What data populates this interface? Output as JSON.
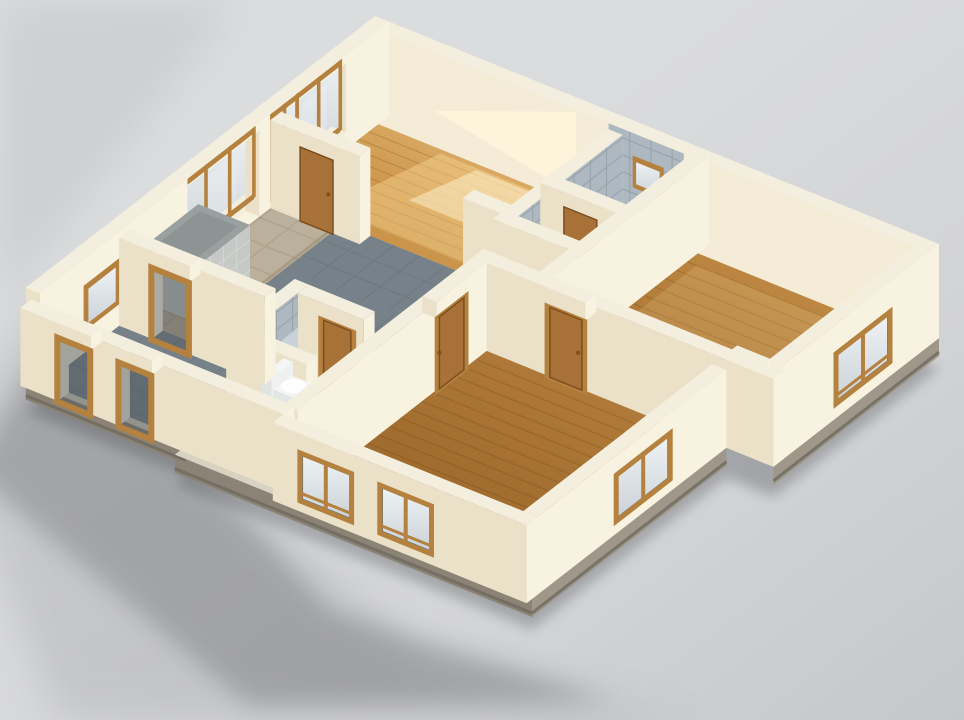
{
  "scene": {
    "description": "Photorealistic 3D isometric cutaway model of an apartment floor plan on a neutral grey studio background: cream plaster walls, oak wood floors and doors, grey tiled hallway and wet rooms, wood-framed glazing along the upper-left facade, soft shadow cast to the lower left",
    "style": "architectural cutaway render",
    "background": "neutral grey studio",
    "camera": "isometric from above"
  },
  "palette": {
    "bg_light": "#dcddde",
    "bg_mid": "#d3d4d6",
    "bg_dark": "#c5c7c9",
    "shadow": "#54575b",
    "wall_top": "#f3eedd",
    "wall_sun": "#f8f3e1",
    "wall_shade": "#eae1c8",
    "wall_inner": "#f4ecd6",
    "slab_side": "#9e978a",
    "slab_dark": "#6f695e",
    "slab_top": "#d8d2c0",
    "wood_light": "#eac183",
    "wood_mid": "#c0893f",
    "wood_dark": "#9a6526",
    "wood_frame": "#b5813f",
    "door_wood": "#a87137",
    "door_dark": "#7c4f1e",
    "tile_hall": "#77818a",
    "tile_bath": "#8b959d",
    "tile_wall": "#adb8c0",
    "tile_line": "#5f6870",
    "pavement": "#b2a58f",
    "pavement_line": "#97896f",
    "concrete": "#b7bab6",
    "concrete_light": "#c6c9c5",
    "concrete_dark": "#9aa0a0",
    "glass_light": "#eef2f4",
    "glass_dark": "#ccd3d8",
    "reveal": "#6b7379",
    "opening_dark": "#4d5459",
    "fixture_white": "#f4f6f5",
    "sun_warm": "#ffdf9e",
    "sun_hot": "#fff3d2"
  },
  "rooms": [
    {
      "id": "living-room",
      "material": "wood-sunlit",
      "features": [
        "sunlight patch",
        "balcony glazed door"
      ]
    },
    {
      "id": "kitchen-dining",
      "material": "stone-pavement",
      "features": [
        "window wall",
        "concrete service shaft"
      ]
    },
    {
      "id": "hallway",
      "material": "tile-hall",
      "features": [
        "oak doors"
      ]
    },
    {
      "id": "entry",
      "material": "tile-hall",
      "features": [
        "standing oak door frames"
      ]
    },
    {
      "id": "bathroom",
      "material": "tile-bath",
      "features": [
        "grey tiled walls",
        "small window",
        "shower tray"
      ]
    },
    {
      "id": "shower-room",
      "material": "tile-bath",
      "features": [
        "grey tiled walls"
      ]
    },
    {
      "id": "wc",
      "material": "tile-bath",
      "features": [
        "toilet",
        "tiled niche wall"
      ]
    },
    {
      "id": "bedroom-right",
      "material": "wood",
      "features": [
        "corner window"
      ]
    },
    {
      "id": "bedroom-bottom",
      "material": "wood-dim",
      "features": [
        "two front windows",
        "side window"
      ]
    }
  ],
  "counts": {
    "rooms": 9,
    "doors": 7,
    "window_bays": 8
  }
}
